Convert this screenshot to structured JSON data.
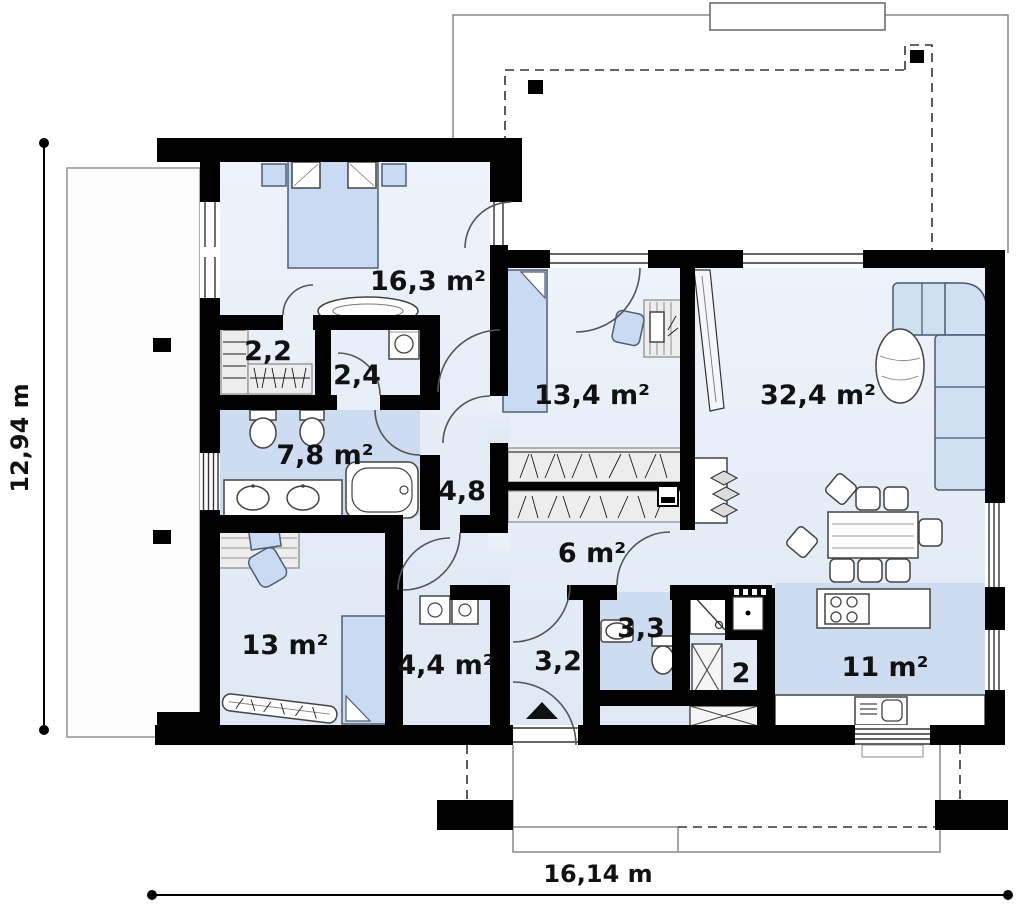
{
  "plan": {
    "type": "floor_plan",
    "rooms": [
      {
        "id": "bedroom-main",
        "area_label": "16,3 m²"
      },
      {
        "id": "wardrobe",
        "area_label": "2,2"
      },
      {
        "id": "utility-small",
        "area_label": "2,4"
      },
      {
        "id": "bathroom",
        "area_label": "7,8 m²"
      },
      {
        "id": "hall-corridor",
        "area_label": "4,8"
      },
      {
        "id": "bedroom-2",
        "area_label": "13,4 m²"
      },
      {
        "id": "living-room",
        "area_label": "32,4 m²"
      },
      {
        "id": "hallway",
        "area_label": "6 m²"
      },
      {
        "id": "bedroom-3",
        "area_label": "13 m²"
      },
      {
        "id": "laundry",
        "area_label": "4,4 m²"
      },
      {
        "id": "entry",
        "area_label": "3,2"
      },
      {
        "id": "wc",
        "area_label": "3,3"
      },
      {
        "id": "pantry",
        "area_label": "2"
      },
      {
        "id": "kitchen",
        "area_label": "11 m²"
      }
    ],
    "dimensions": {
      "overall_width": "16,14 m",
      "overall_height": "12,94 m"
    },
    "colors": {
      "wall": "#000000",
      "floor_light": "#e9eef8",
      "floor_wet": "#cddcf1",
      "furniture_blue": "#c9daf2",
      "background": "#ffffff"
    }
  }
}
